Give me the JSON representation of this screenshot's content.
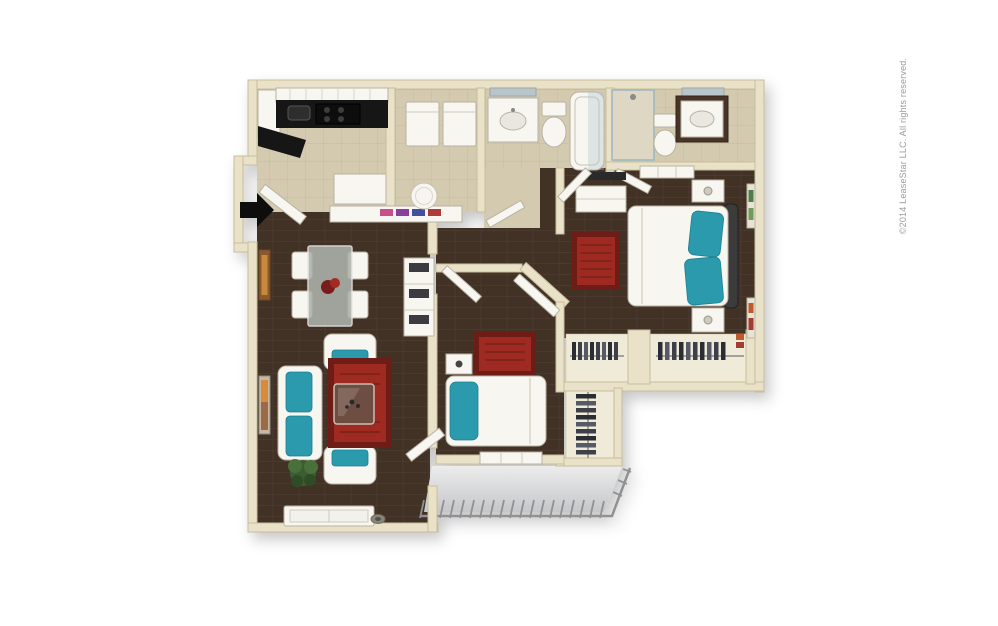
{
  "watermark": {
    "text": "©2014 LeaseStar LLC. All rights reserved."
  },
  "palette": {
    "background": "#ffffff",
    "wall": "#eae2c8",
    "wall_edge": "#c8bd9b",
    "wood_floor": "#423027",
    "wood_plank_line": "#524034",
    "tile_floor": "#d3caaf",
    "tile_line": "#c2b795",
    "closet_floor": "#f0ead8",
    "counter_black": "#161616",
    "furniture_white": "#f7f6f1",
    "furniture_edge": "#b9b3a4",
    "accent_teal": "#2b9aac",
    "rug_red": "#9e2a22",
    "rug_red_dark": "#6e1e18",
    "patio_light": "#ececec",
    "patio_dark": "#c6c7c9",
    "railing_gray": "#909194",
    "plant_green": "#3c5c31",
    "glass_blue": "#aac4cc",
    "vanity_wood": "#4a3526",
    "arrow_black": "#0a0a0a",
    "watermark_gray": "#9b9b9b"
  },
  "floorplan": {
    "style": "3d-rendered-top-down-apartment",
    "entry_indicator": "arrow-right-icon",
    "rooms": [
      {
        "name": "kitchen",
        "floor": "tile",
        "features": [
          "l-shaped-black-counter",
          "stove",
          "sink",
          "upper-cabinets",
          "breakfast-bar"
        ]
      },
      {
        "name": "laundry-room",
        "floor": "tile",
        "features": [
          "washer",
          "dryer",
          "laundry-basket"
        ]
      },
      {
        "name": "bathroom-1",
        "floor": "tile",
        "features": [
          "vanity-sink",
          "mirror",
          "toilet",
          "bathtub-shower"
        ]
      },
      {
        "name": "bathroom-2",
        "floor": "tile",
        "features": [
          "walk-in-shower",
          "toilet",
          "wood-vanity-sink",
          "mirror"
        ]
      },
      {
        "name": "master-bedroom",
        "floor": "wood",
        "features": [
          "bed-teal-pillows",
          "dresser",
          "two-nightstands",
          "red-rug",
          "window",
          "wall-art"
        ]
      },
      {
        "name": "master-closets",
        "floor": "light",
        "features": [
          "hanging-clothes"
        ]
      },
      {
        "name": "bedroom-2",
        "floor": "wood",
        "features": [
          "bed-teal-pillow",
          "nightstand",
          "red-rug",
          "window",
          "walk-in-closet"
        ]
      },
      {
        "name": "dining-area",
        "floor": "wood",
        "features": [
          "glass-table",
          "four-white-chairs",
          "red-centerpiece",
          "wall-art",
          "shelf-unit"
        ]
      },
      {
        "name": "living-room",
        "floor": "wood",
        "features": [
          "sofa-teal-cushions",
          "two-armchairs-teal",
          "glass-coffee-table",
          "red-rug",
          "plant",
          "window"
        ]
      },
      {
        "name": "hallway",
        "floor": "wood",
        "features": [
          "angled-doors"
        ]
      },
      {
        "name": "patio",
        "floor": "concrete",
        "features": [
          "slat-railing"
        ]
      }
    ]
  }
}
